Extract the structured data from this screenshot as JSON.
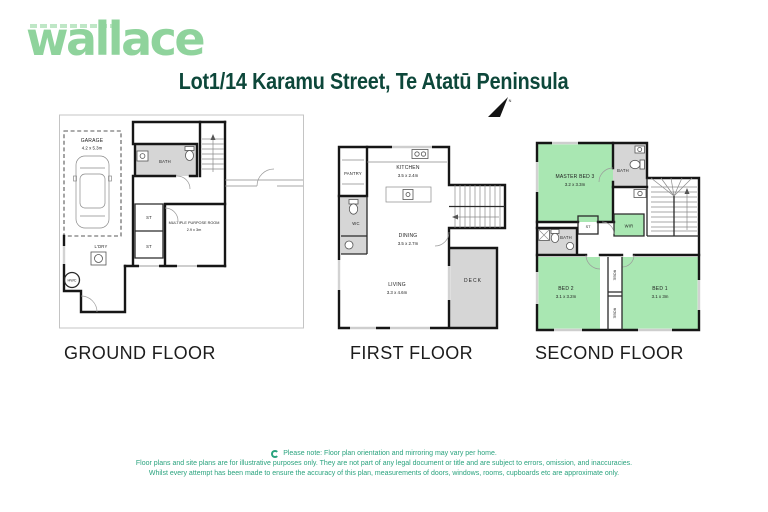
{
  "brand": {
    "logo_text": "wallace"
  },
  "header": {
    "title": "Lot1/14 Karamu Street, Te Atatū Peninsula",
    "north_label": "N"
  },
  "floors": {
    "ground": {
      "label": "GROUND FLOOR",
      "garage_name": "GARAGE",
      "garage_dims": "4.2 x 5.3m",
      "bath": "BATH",
      "st_upper": "ST",
      "st_lower": "ST",
      "mpr_name": "MULTIPLE PURPOSE ROOM",
      "mpr_dims": "2.9 x 3m",
      "ldry": "L'DRY",
      "hwc": "HWC"
    },
    "first": {
      "label": "FIRST FLOOR",
      "pantry": "PANTRY",
      "kitchen_name": "KITCHEN",
      "kitchen_dims": "3.5 x 2.4m",
      "wc": "WC",
      "dining_name": "DINING",
      "dining_dims": "3.5 x 2.7m",
      "living_name": "LIVING",
      "living_dims": "3.3 x 4.6m",
      "deck": "DECK"
    },
    "second": {
      "label": "SECOND FLOOR",
      "master_name": "MASTER BED 3",
      "master_dims": "3.2 x 3.3m",
      "bath_top": "BATH",
      "bath_lower": "BATH",
      "st": "ST",
      "wir": "WIR",
      "robe_upper": "ROBE",
      "robe_lower": "ROBE",
      "bed2_name": "BED 2",
      "bed2_dims": "3.1 x 3.2m",
      "bed1_name": "BED 1",
      "bed1_dims": "3.1 x 3m"
    }
  },
  "footer": {
    "note_line1": "Please note: Floor plan orientation and mirroring may vary per home.",
    "note_line2": "Floor plans and site plans are for illustrative purposes only. They are not part of any legal document or title and are subject to errors, omission, and inaccuracies.",
    "note_line3": "Whilst every attempt has been made to ensure the accuracy of this plan, measurements of doors, windows, rooms, cupboards etc are approximate only."
  },
  "colors": {
    "brand_green": "#8fd39c",
    "title_green": "#0d473a",
    "room_green": "#a9e7b2",
    "fixture_gray": "#d6d6d6",
    "note_green": "#2aa37e"
  }
}
